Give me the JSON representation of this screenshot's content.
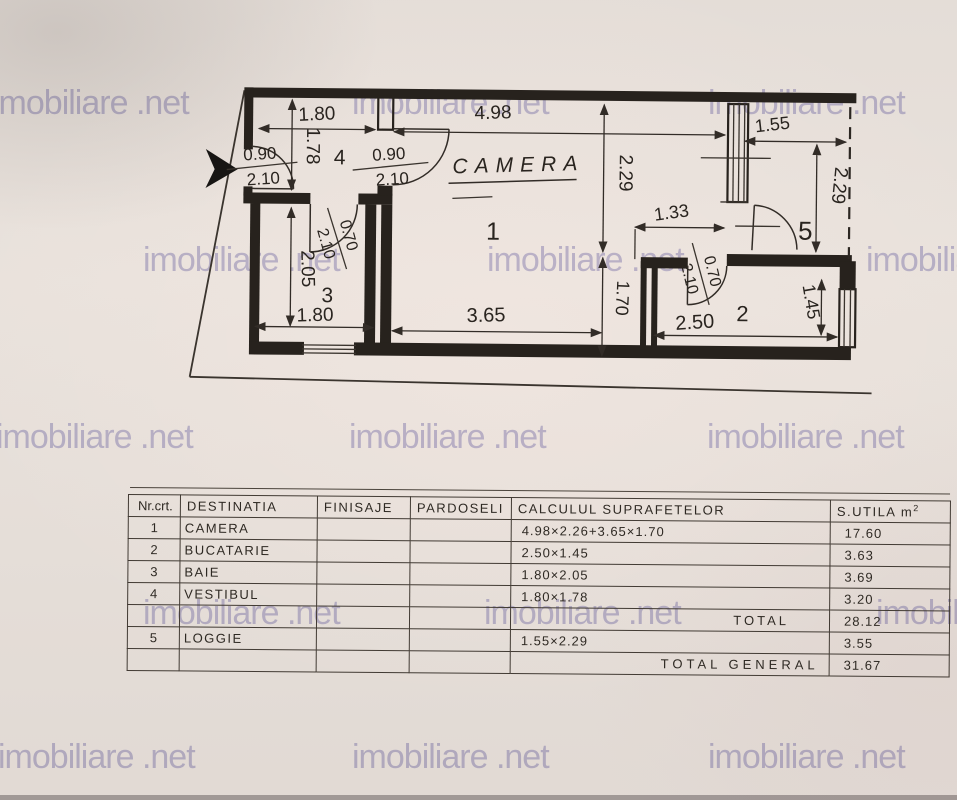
{
  "watermark": {
    "text": "imobiliare .net",
    "color": "#8f8bc7"
  },
  "plan": {
    "title": "CAMERA",
    "rooms": {
      "camera": "1",
      "bucatarie": "2",
      "baie": "3",
      "vestibul": "4",
      "loggie": "5"
    },
    "dims": {
      "vestibul_w": "1.80",
      "camera_w_top": "4.98",
      "loggie_w": "1.55",
      "vestibul_h": "1.78",
      "camera_h": "2.29",
      "loggie_h": "2.29",
      "nook_w": "1.33",
      "baie_h": "2.05",
      "camera_lower_h": "1.70",
      "baie_w": "1.80",
      "camera_w_bottom": "3.65",
      "bucatarie_w": "2.50",
      "bucatarie_h": "1.45"
    },
    "doors": {
      "entrance_w": "0.90",
      "entrance_h": "2.10",
      "camera_w": "0.90",
      "camera_h": "2.10",
      "baie_w": "0.70",
      "baie_h": "2.10",
      "bucatarie_w": "0.70",
      "bucatarie_h": "2.10"
    }
  },
  "table": {
    "headers": [
      "Nr.crt.",
      "DESTINATIA",
      "FINISAJE",
      "PARDOSELI",
      "CALCULUL SUPRAFETELOR",
      "S.UTILA m"
    ],
    "unit_sup": "2",
    "rows": [
      {
        "nr": "1",
        "dest": "CAMERA",
        "fin": "",
        "pard": "",
        "calc": "4.98×2.26+3.65×1.70",
        "s": "17.60"
      },
      {
        "nr": "2",
        "dest": "BUCATARIE",
        "fin": "",
        "pard": "",
        "calc": "2.50×1.45",
        "s": "3.63"
      },
      {
        "nr": "3",
        "dest": "BAIE",
        "fin": "",
        "pard": "",
        "calc": "1.80×2.05",
        "s": "3.69"
      },
      {
        "nr": "4",
        "dest": "VESTIBUL",
        "fin": "",
        "pard": "",
        "calc": "1.80×1.78",
        "s": "3.20"
      },
      {
        "nr": "5",
        "dest": "LOGGIE",
        "fin": "",
        "pard": "",
        "calc": "1.55×2.29",
        "s": "3.55"
      }
    ],
    "total_label": "TOTAL",
    "total_value": "28.12",
    "total_general_label": "TOTAL GENERAL",
    "total_general_value": "31.67"
  }
}
